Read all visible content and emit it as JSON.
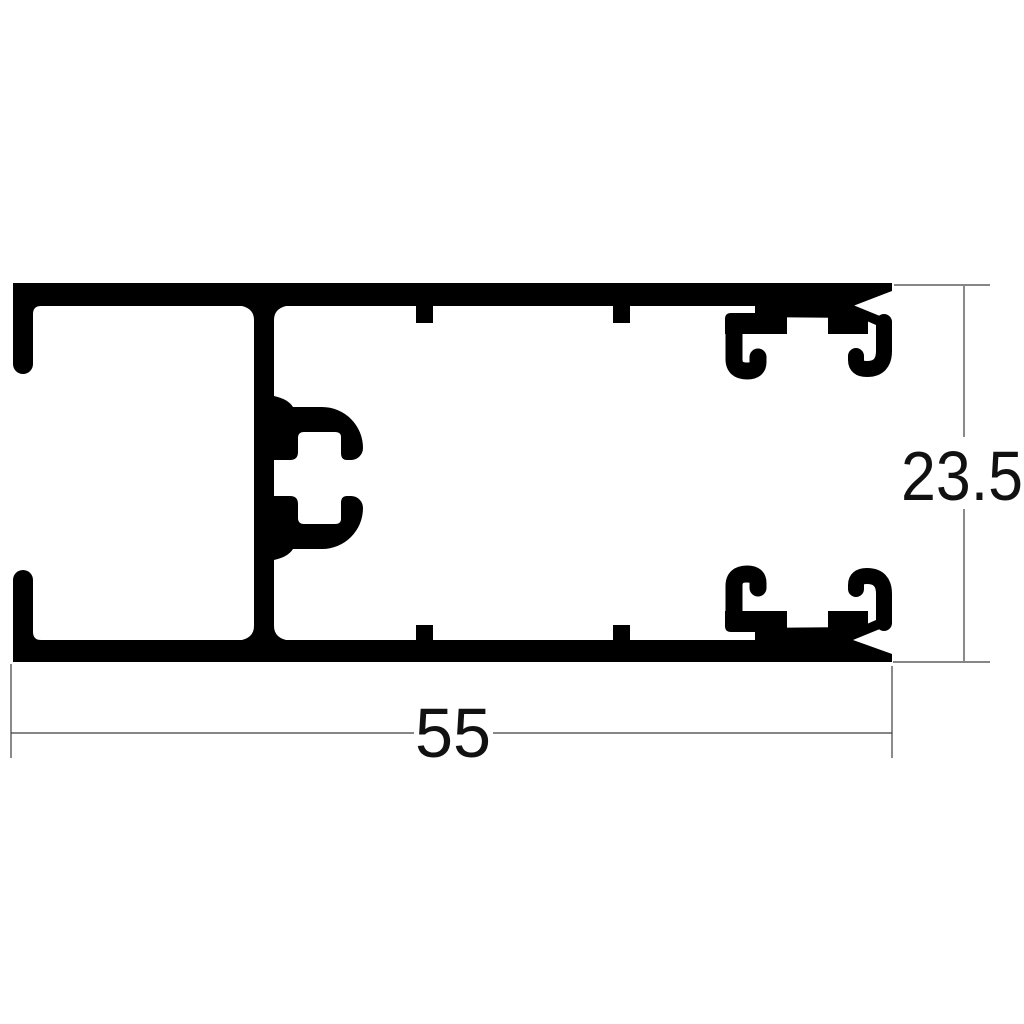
{
  "drawing": {
    "kind": "aluminium-extrusion-profile-cross-section",
    "description": "Black cross-section technical drawing of an aluminium window frame profile with two glazing-bead snap channels on the right, an accessory clip on the central web, C-channel openings on the left, and linear dimensions",
    "colors": {
      "background": "#ffffff",
      "profile": "#000000",
      "dimension_lines": "#3d3d3d",
      "dimension_text": "#111111"
    },
    "dimensions": {
      "overall_width": {
        "value": "55",
        "orientation": "horizontal",
        "position": "below-profile"
      },
      "overall_height": {
        "value": "23.5",
        "orientation": "vertical",
        "position": "right-of-profile"
      }
    }
  }
}
